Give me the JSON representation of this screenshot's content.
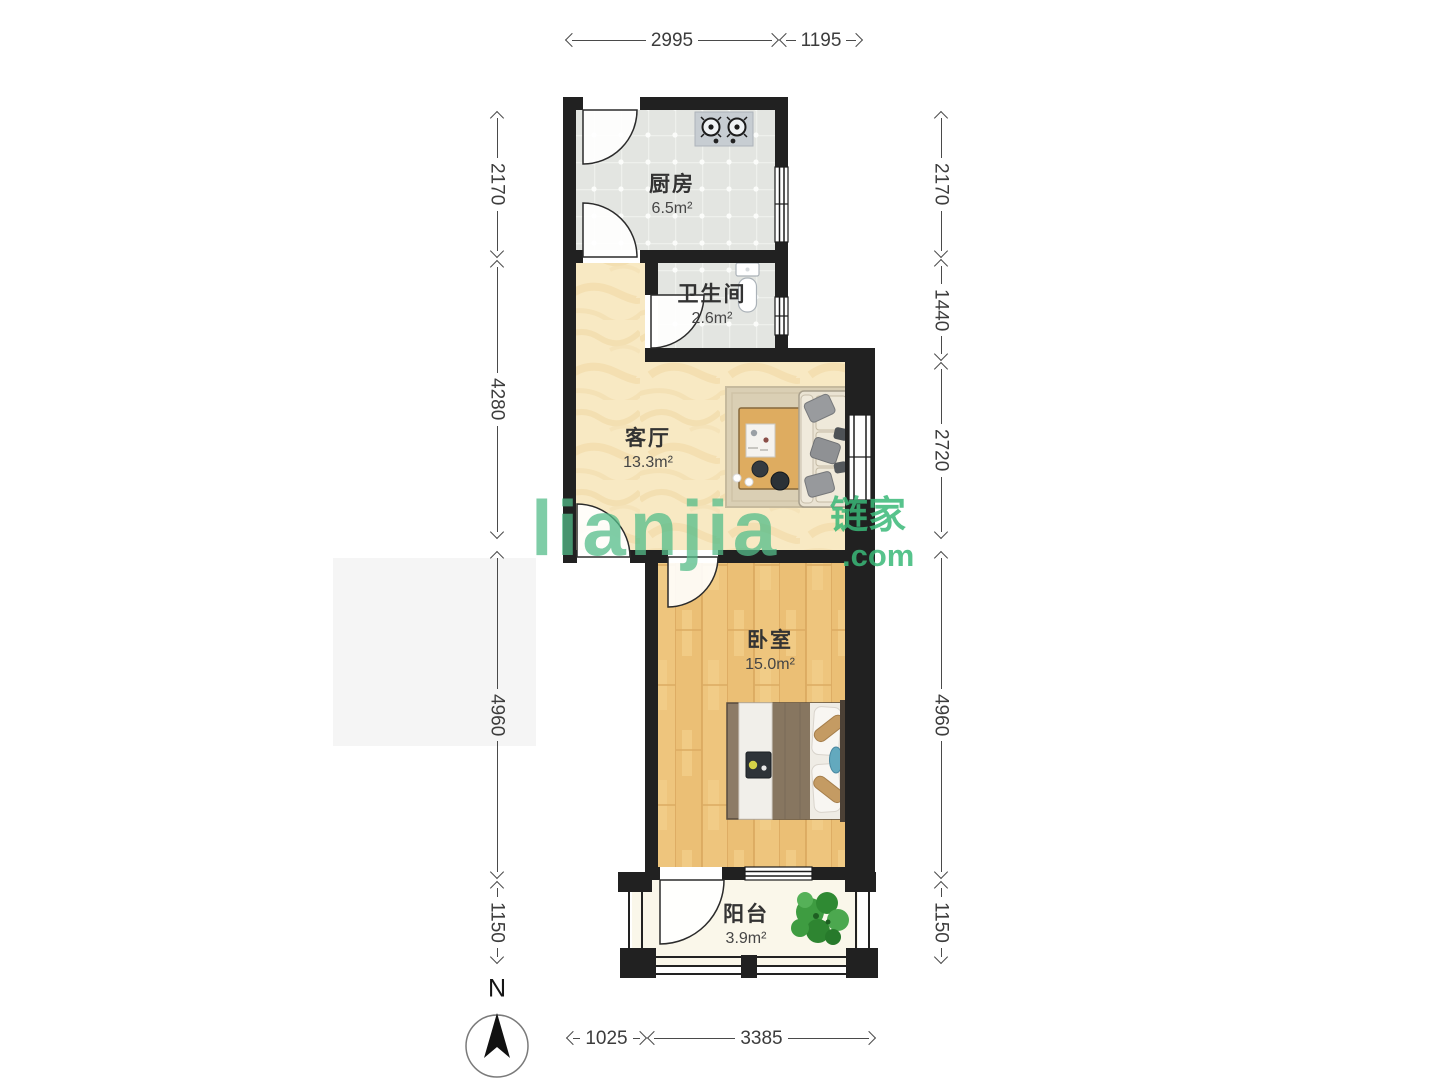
{
  "watermark": {
    "logo": "lianjia",
    "cjk": "链家",
    "tld": ".com"
  },
  "compass": {
    "north_label": "N"
  },
  "rooms": [
    {
      "name": "厨房",
      "area": "6.5m²"
    },
    {
      "name": "卫生间",
      "area": "2.6m²"
    },
    {
      "name": "客厅",
      "area": "13.3m²"
    },
    {
      "name": "卧室",
      "area": "15.0m²"
    },
    {
      "name": "阳台",
      "area": "3.9m²"
    }
  ],
  "dimensions": {
    "top": [
      "2995",
      "1195"
    ],
    "bottom": [
      "1025",
      "3385"
    ],
    "left": [
      "2170",
      "4280",
      "4960",
      "1150"
    ],
    "right": [
      "2170",
      "1440",
      "2720",
      "4960",
      "1150"
    ]
  },
  "colors": {
    "wall": "#212121",
    "watermark_green": "#4FBC87",
    "living_floor": "#F8E9C3",
    "bedroom_floor": "#EEC57D",
    "tile_floor": "#E3E5E1",
    "balcony_floor": "#FAF7EA"
  }
}
